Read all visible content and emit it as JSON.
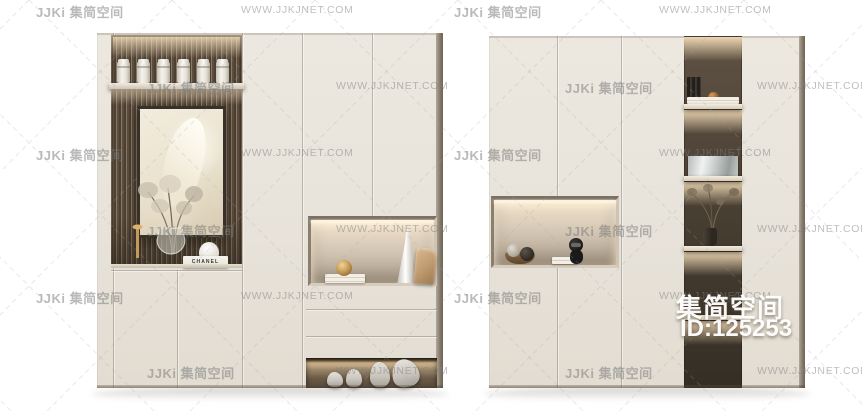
{
  "watermarks": {
    "logo": "JJKi 集简空间",
    "url": "WWW.JJKJNET.COM"
  },
  "overlay": {
    "brand": "集简空间",
    "item_id": "ID:125253"
  },
  "decor": {
    "chanel_label": "CHANEL"
  },
  "colors": {
    "background": "#ffffff",
    "cabinet_face": "#e9e4db",
    "niche_wood": "#564a3c",
    "warm_light": "#f6e8d0",
    "watermark_gray": "#7d7d7d",
    "overlay_text": "#ffffff"
  }
}
